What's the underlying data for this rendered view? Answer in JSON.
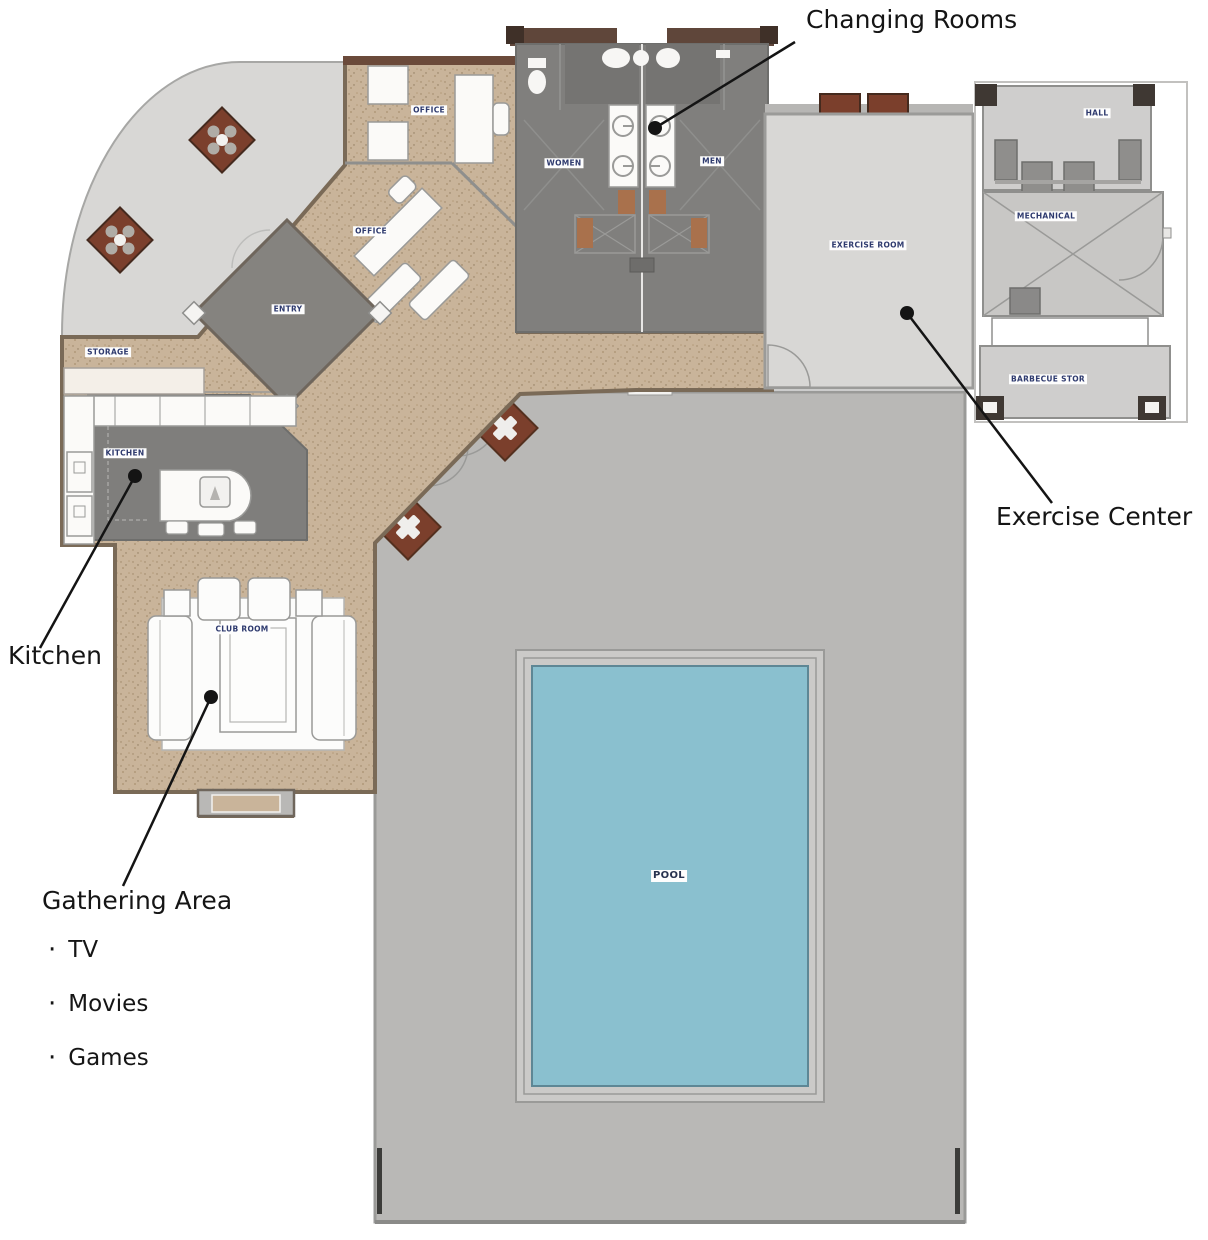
{
  "annotations": {
    "changing_rooms": "Changing Rooms",
    "exercise_center": "Exercise Center",
    "kitchen": "Kitchen",
    "gathering_title": "Gathering Area",
    "bullet_char": "·",
    "gathering_items": [
      "TV",
      "Movies",
      "Games"
    ]
  },
  "room_labels": {
    "office_upper": "OFFICE",
    "office_lower": "OFFICE",
    "entry": "ENTRY",
    "storage": "STORAGE",
    "kitchen": "KITCHEN",
    "club_room": "CLUB ROOM",
    "women": "WOMEN",
    "men": "MEN",
    "exercise_room": "EXERCISE ROOM",
    "mechanical": "MECHANICAL",
    "hall": "HALL",
    "barbecue_storage": "BARBECUE STOR",
    "pool": "POOL"
  },
  "colors": {
    "pool_water": "#8ac0cf",
    "pool_deck": "#b9b8b6",
    "floor_tan": "#c9b49a",
    "room_gray": "#807f7d",
    "light_gray": "#d8d7d5",
    "planter_red": "#7b3f2c",
    "wall_brown": "#5f4a3e",
    "annotation_ink": "#141414",
    "room_label_text": "#2e3a6e"
  }
}
